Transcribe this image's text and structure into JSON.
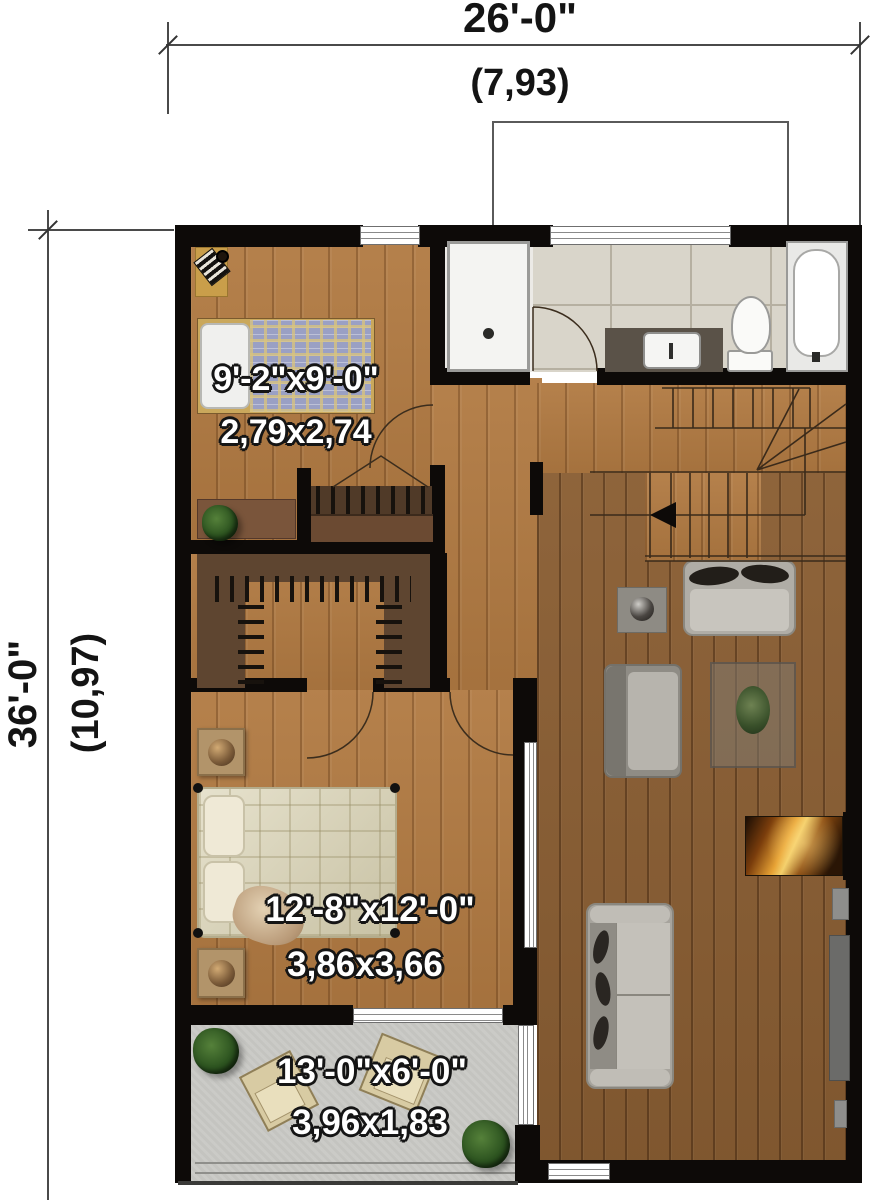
{
  "title": "Second floor plan",
  "dimensions": {
    "width_imperial": "26'-0\"",
    "width_metric": "(7,93)",
    "height_imperial": "36'-0\"",
    "height_metric": "(10,97)"
  },
  "rooms": [
    {
      "id": "bedroom-1",
      "size_imperial": "9'-2\"x9'-0\"",
      "size_metric": "2,79x2,74"
    },
    {
      "id": "bedroom-2",
      "size_imperial": "12'-8\"x12'-0\"",
      "size_metric": "3,86x3,66"
    },
    {
      "id": "balcony",
      "size_imperial": "13'-0\"x6'-0\"",
      "size_metric": "3,96x1,83"
    }
  ],
  "features": [
    "bathroom",
    "walk-in-closet",
    "closet",
    "stairs",
    "living-area",
    "fireplace",
    "balcony"
  ],
  "colors": {
    "wall": "#0d0a08",
    "wood_light": "#b17a42",
    "wood_dark": "#8a5e33",
    "tile": "#d9d5ca",
    "concrete": "#c9c9c5",
    "flame": "#e8a335",
    "dimension_line": "#4a4a4a",
    "label_text": "#ffffff",
    "dimension_text": "#141414"
  }
}
